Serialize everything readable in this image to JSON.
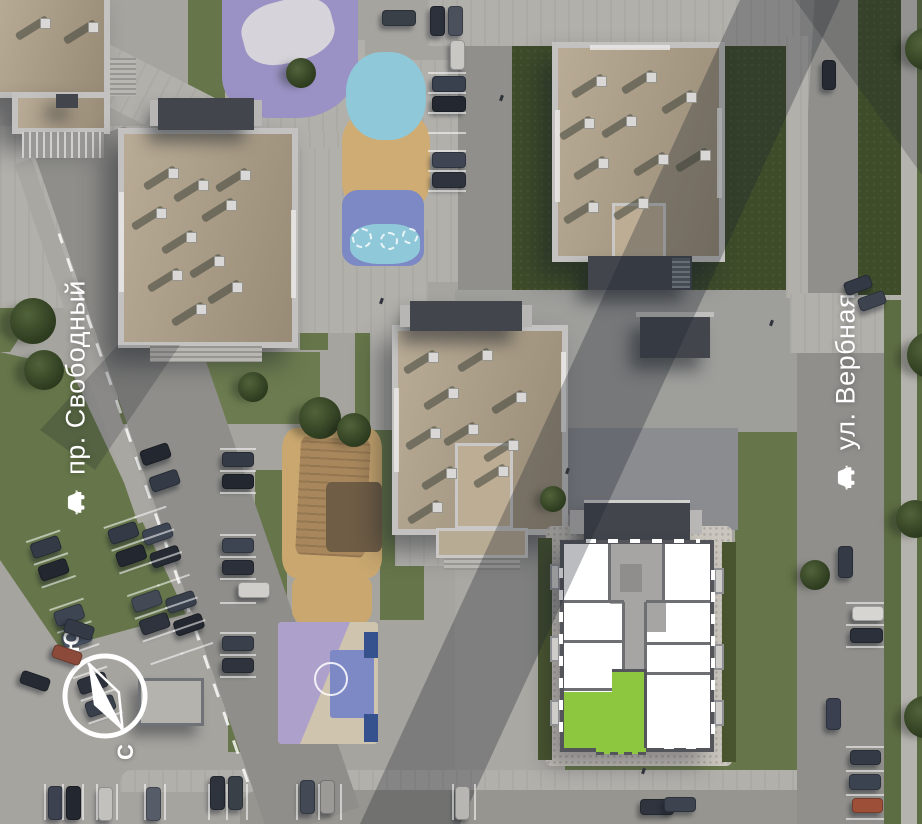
{
  "streets": {
    "left": {
      "name": "пр. Свободный",
      "icon": "car-icon"
    },
    "right": {
      "name": "ул. Вербная",
      "icon": "car-icon"
    }
  },
  "compass": {
    "north_label": "С",
    "south_label": "Ю"
  },
  "selection": {
    "highlight_color": "#8dc63f"
  },
  "palette": {
    "grass": "#66764a",
    "grass_dark": "#3e4c2a",
    "asphalt": "#908f8b",
    "pavement": "#a6a49f",
    "plaza": "#b2b0ab",
    "roof_tan": "#b1a28a",
    "parapet": "#c3c2c0",
    "canopy_dark": "#42464c",
    "plan_wall": "#54555a",
    "plan_room": "#ffffff",
    "plan_core": "#a7a5a3",
    "playground_purple": "#9a92c4",
    "playground_blue": "#8fc8d8",
    "playground_sand": "#cfac74",
    "court_violet": "#7d89c5"
  }
}
